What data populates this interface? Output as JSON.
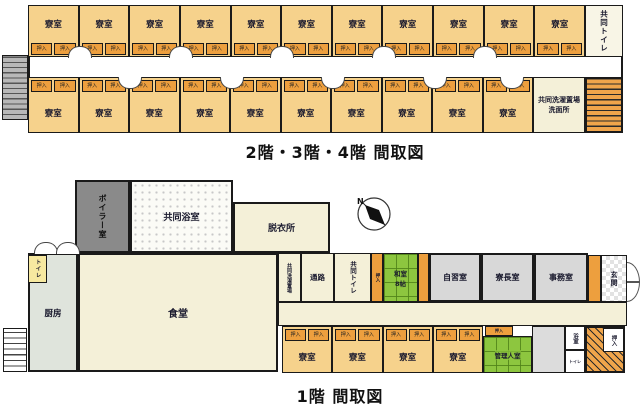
{
  "upper_plan": {
    "title": "2階・3階・4階  間取図",
    "room_label": "寮室",
    "closet_label": "押入",
    "top_row_count": 11,
    "bottom_row_count": 10,
    "shared_toilet": "共同トイレ",
    "laundry_line1": "共同洗濯置場",
    "laundry_line2": "洗面所"
  },
  "lower_plan": {
    "title": "1階  間取図",
    "boiler": "ボイラー室",
    "shared_bath": "共同浴室",
    "dressing": "脱衣所",
    "kitchen": "厨房",
    "toilet_small": "トイレ",
    "dining": "食堂",
    "laundry_v": "共同洗濯置場",
    "passage": "通路",
    "shared_toilet_v": "共同トイレ",
    "closet": "押入",
    "washitsu_line1": "和室",
    "washitsu_line2": "8帖",
    "study": "自習室",
    "dorm_leader": "寮長室",
    "office": "事務室",
    "entrance": "玄関",
    "manager": "管理人室",
    "bath": "浴室",
    "toilet_tiny": "トイレ",
    "room_label": "寮室",
    "bottom_room_count": 4
  },
  "compass": {
    "label": "N"
  },
  "colors": {
    "room_tan": "#F6D28C",
    "closet_orange": "#ED9F3E",
    "cream": "#F4F0D8",
    "gray_room": "#D8D8D8",
    "boiler_gray": "#8A8A8A",
    "kitchen_gray": "#DFE4DC",
    "tatami_green": "#8DC63F",
    "stairs_orange": "#F0A54B",
    "toilet_yellow": "#F7E9A0",
    "wall": "#1A1A1A"
  }
}
